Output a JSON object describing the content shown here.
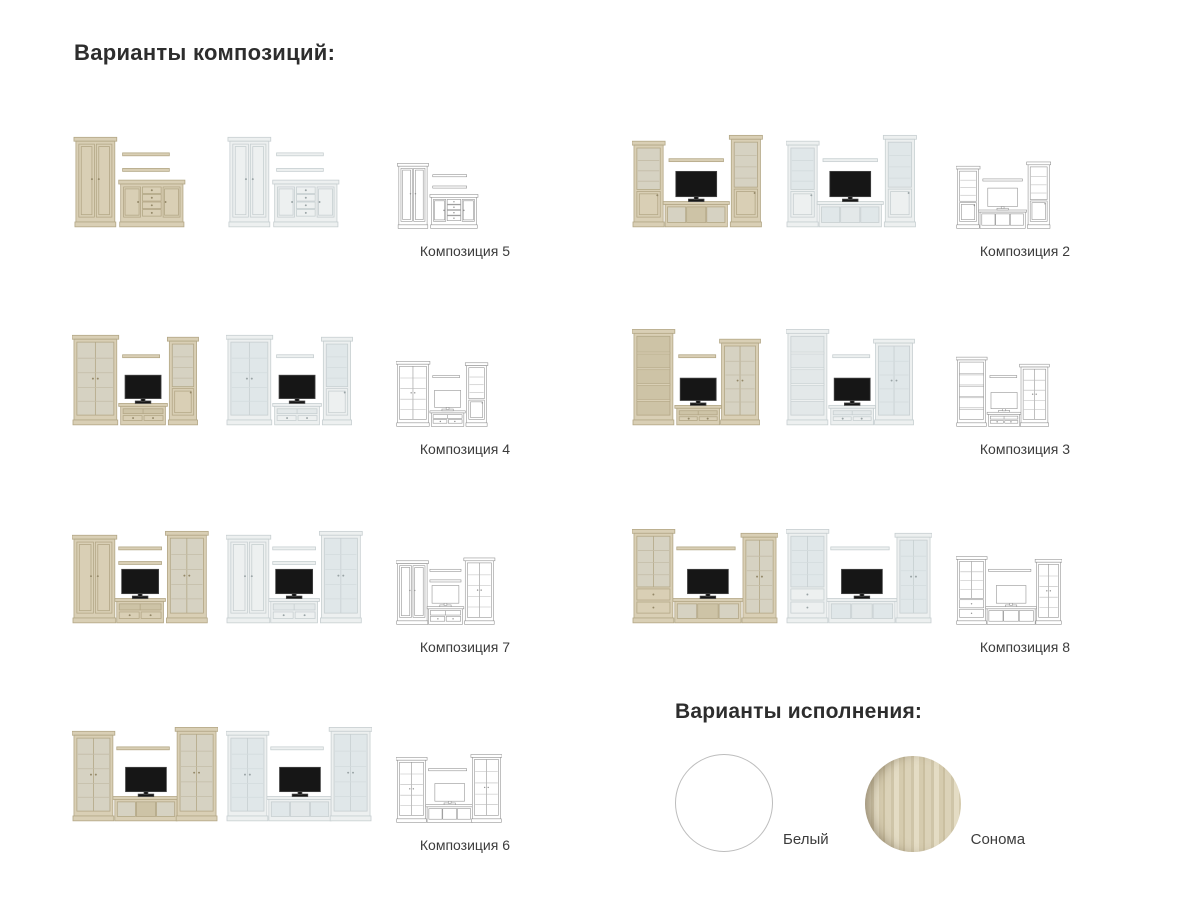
{
  "page": {
    "title": "Варианты композиций:",
    "finishes_title": "Варианты исполнения:"
  },
  "compositions": [
    {
      "id": "c5",
      "label": "Композиция 5",
      "variants": [
        "sonoma",
        "white",
        "wireframe"
      ]
    },
    {
      "id": "c2",
      "label": "Композиция 2",
      "variants": [
        "sonoma",
        "white",
        "wireframe"
      ]
    },
    {
      "id": "c4",
      "label": "Композиция 4",
      "variants": [
        "sonoma",
        "white",
        "wireframe"
      ]
    },
    {
      "id": "c3",
      "label": "Композиция 3",
      "variants": [
        "sonoma",
        "white",
        "wireframe"
      ]
    },
    {
      "id": "c7",
      "label": "Композиция 7",
      "variants": [
        "sonoma",
        "white",
        "wireframe"
      ]
    },
    {
      "id": "c8",
      "label": "Композиция 8",
      "variants": [
        "sonoma",
        "white",
        "wireframe"
      ]
    },
    {
      "id": "c6",
      "label": "Композиция 6",
      "variants": [
        "sonoma",
        "white",
        "wireframe"
      ]
    }
  ],
  "finishes": [
    {
      "id": "white",
      "label": "Белый",
      "color": "#ffffff"
    },
    {
      "id": "sonoma",
      "label": "Сонома",
      "color": "#d6cbb0"
    }
  ]
}
